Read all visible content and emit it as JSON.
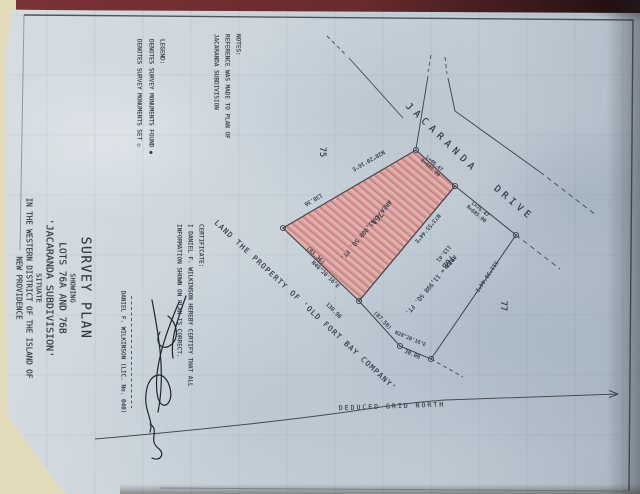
{
  "title_block": {
    "title": "SURVEY PLAN",
    "showing": "SHOWING",
    "lots": "LOTS 76A AND 76B",
    "subdivision": "'JACARANDA SUBDIVISION'",
    "situate": "SITUATE",
    "district": "IN THE WESTERN DISTRICT OF THE ISLAND OF",
    "island": "NEW PROVIDENCE"
  },
  "notes": {
    "heading": "NOTES:",
    "line1": "REFERENCE WAS MADE TO PLAN OF",
    "line2": "JACARANDA SUBDIVISION"
  },
  "legend": {
    "heading": "LEGEND:",
    "found": "DENOTES SURVEY MONUMENTS FOUND",
    "found_symbol": "●",
    "set": "DENOTES SURVEY MONUMENTS SET",
    "set_symbol": "○"
  },
  "certificate": {
    "heading": "CERTIFICATE:",
    "line1": "I DANIEL F. WILKINSON HEREBY CERTIFY THAT ALL",
    "line2": "INFORMATION SHOWN ON PLAN IS CORRECT.",
    "signatory": "DANIEL F. WILKINSON (LIC. No. 040)"
  },
  "road": {
    "upper": "JACARANDA",
    "lower": "DRIVE"
  },
  "parcels": {
    "a": {
      "id": "76A",
      "area": "AREA = 11,908 SQ. FT."
    },
    "b": {
      "id": "76B",
      "area": "AREA = 11,998 SQ. FT."
    }
  },
  "adjoining": {
    "lot_nw": "75",
    "lot_se": "77",
    "south": "LAND THE PROPERTY OF 'OLD FORT BAY COMPANY'"
  },
  "dims": {
    "nw_bearing": "N28°20'16\"E",
    "nw_dist": "138.36",
    "curve1_l": "L=46.47",
    "curve1_r": "R=685.00",
    "curve2_l": "L=76.47",
    "curve2_r": "R=685.00",
    "div_bearing": "N73°55'44\"E",
    "div_dist": "115.41",
    "back_a_dist": "(93.36)",
    "back_a_bearing": "N48°20'16\"E",
    "back_b_dist": "130.98",
    "back_b_paren": "(87.50)",
    "jog_bearing": "N28°20'16\"E",
    "jog_dist": "30.00",
    "se_bearing": "S11°39'44\"E"
  },
  "north": {
    "label": "DEDUCED GRID NORTH"
  }
}
